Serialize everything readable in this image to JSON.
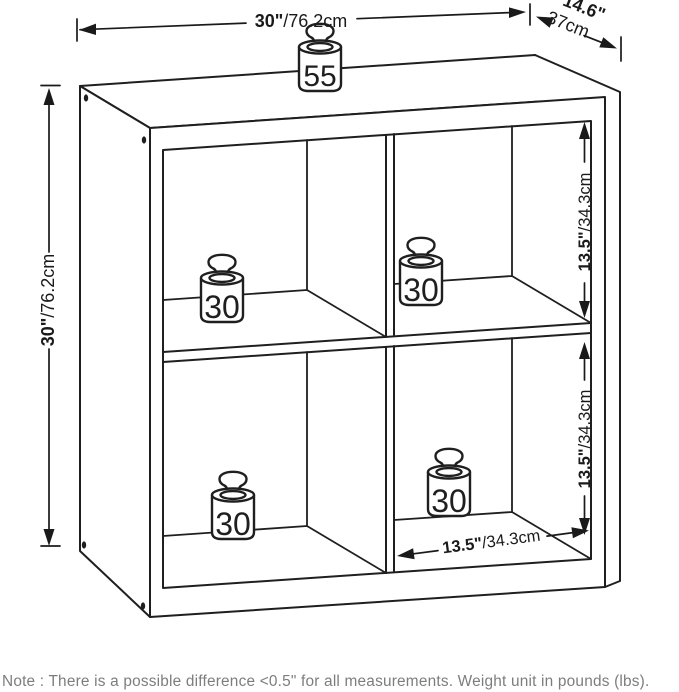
{
  "dimensions": {
    "width": {
      "inches": "30\"",
      "cm": "/76.2cm"
    },
    "depth": {
      "inches": "14.6\"",
      "cm": "37cm"
    },
    "height": {
      "inches": "30\"",
      "cm": "/76.2cm"
    },
    "cube_height_top": {
      "inches": "13.5\"",
      "cm": "/34.3cm"
    },
    "cube_height_bottom": {
      "inches": "13.5\"",
      "cm": "/34.3cm"
    },
    "cube_width": {
      "inches": "13.5\"",
      "cm": "/34.3cm"
    }
  },
  "weights": {
    "unit": "lbs",
    "top": "55",
    "cube_top_left": "30",
    "cube_top_right": "30",
    "cube_bottom_left": "30",
    "cube_bottom_right": "30"
  },
  "note": "Note : There is a possible difference <0.5\" for all measurements. Weight unit in pounds (lbs).",
  "colors": {
    "line": "#1f1f1f",
    "dimension_text": "#1a1a1a",
    "note_text": "#7d7d7d",
    "background": "#ffffff"
  }
}
